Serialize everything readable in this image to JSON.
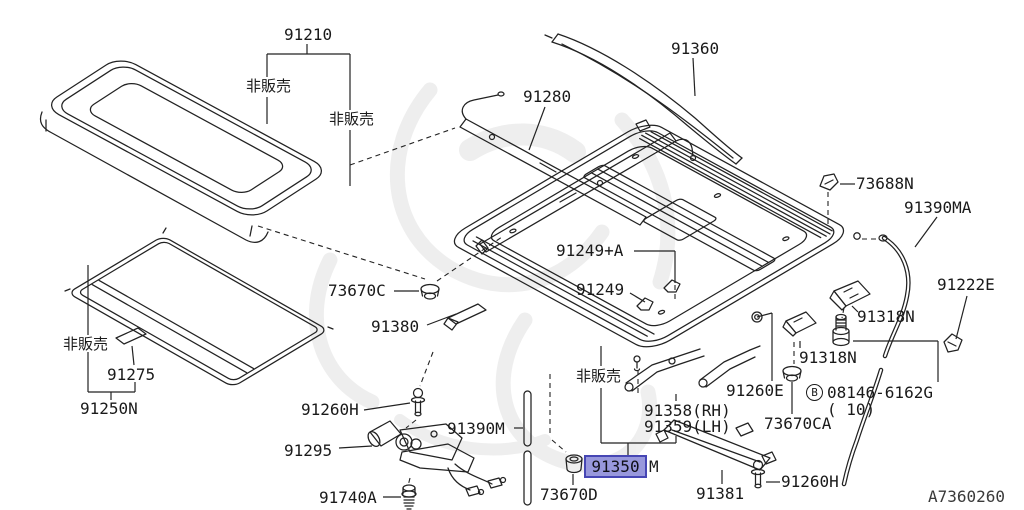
{
  "diagram": {
    "drawing_code": "A7360260",
    "selected_part": "91350",
    "colors": {
      "line": "#222222",
      "background": "#ffffff",
      "highlight_fill": "#9898dc",
      "highlight_border": "#4646b4",
      "watermark": "#e2e2e2"
    }
  },
  "labels": {
    "not_for_sale": "非販売",
    "p91210": "91210",
    "p91280": "91280",
    "p91360": "91360",
    "p73688n": "73688N",
    "p91390ma": "91390MA",
    "p91222e": "91222E",
    "p91318n": "91318N",
    "p73670c": "73670C",
    "p91380": "91380",
    "p91249a": "91249+A",
    "p91249": "91249",
    "p91275": "91275",
    "p91250n": "91250N",
    "p91260e": "91260E",
    "bolt_prefix": "B",
    "bolt_number": "08146-6162G",
    "bolt_qty": "( 10)",
    "p73670ca": "73670CA",
    "p91358": "91358(RH)",
    "p91359": "91359(LH)",
    "p91350": "91350",
    "p91350_suffix": "M",
    "p73670d": "73670D",
    "p91381": "91381",
    "p91260h": "91260H",
    "p91295": "91295",
    "p91740a": "91740A",
    "p91390m": "91390M",
    "drawing_code": "A7360260"
  }
}
